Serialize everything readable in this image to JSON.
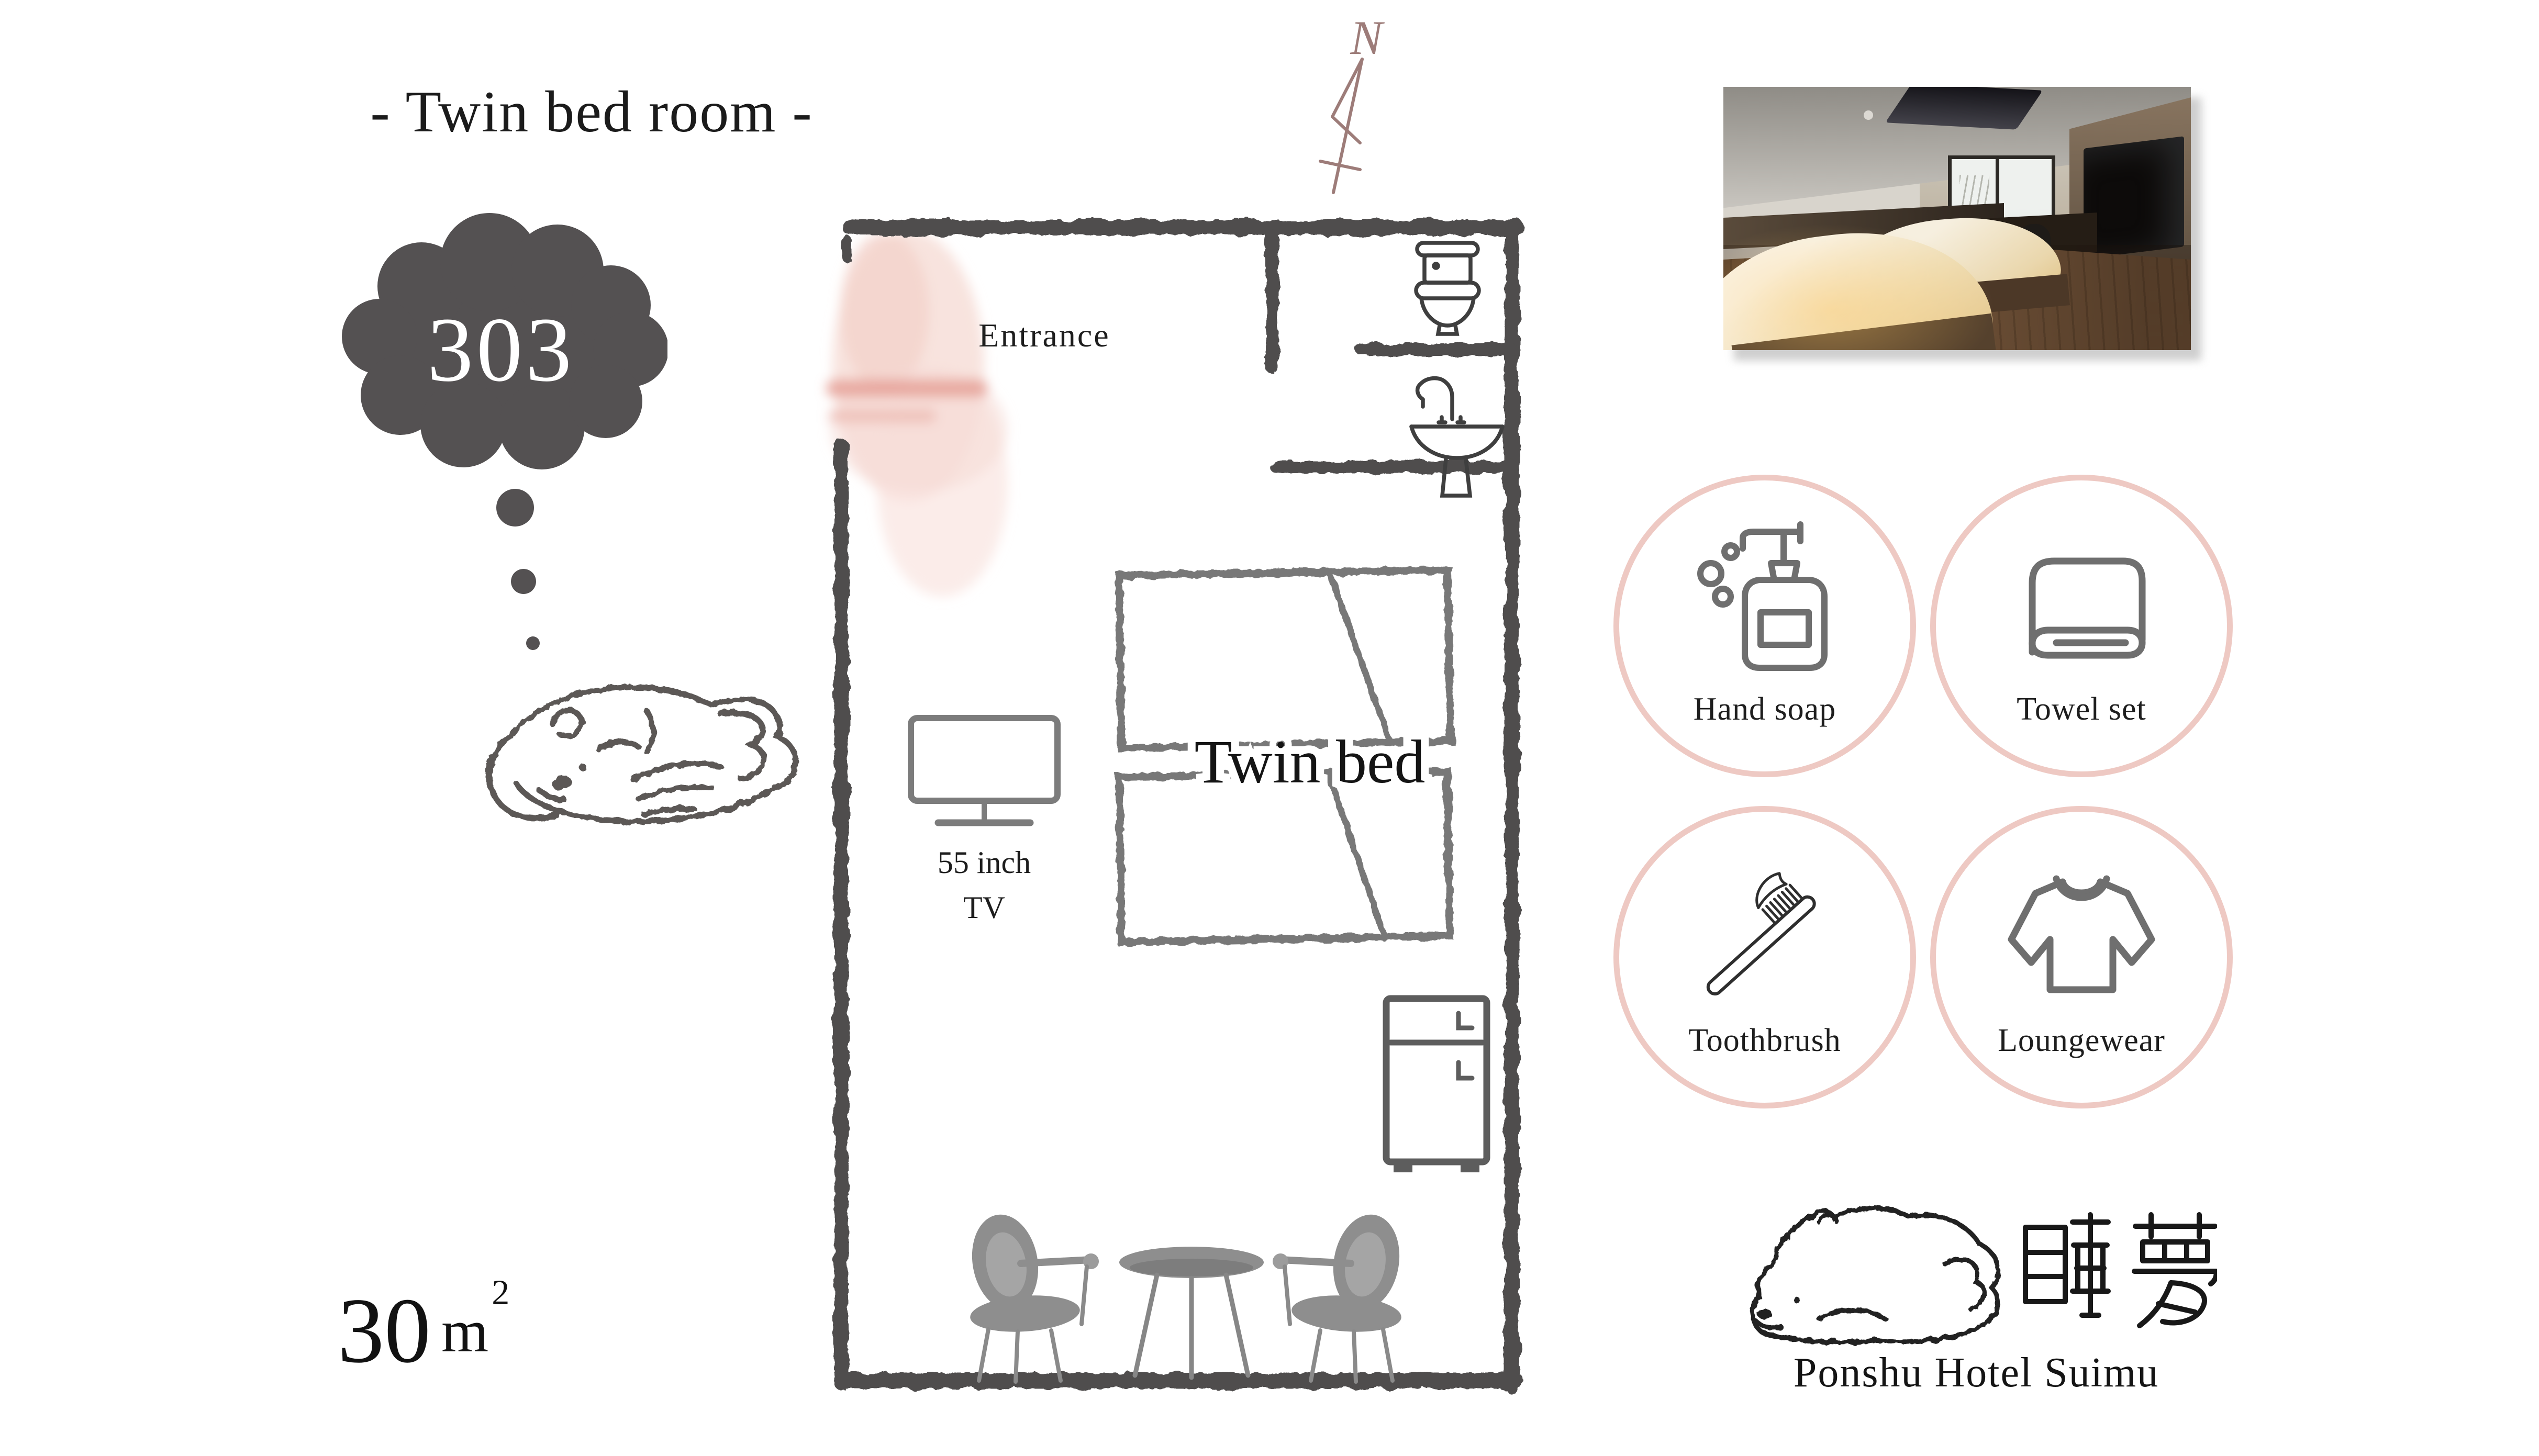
{
  "title": "- Twin bed room -",
  "room": {
    "number": "303",
    "area_value": "30",
    "area_unit": "m",
    "area_exponent": "2"
  },
  "compass": {
    "north_label": "N"
  },
  "floorplan": {
    "entrance_label": "Entrance",
    "bed_label": "Twin bed",
    "tv_label_line1": "55 inch",
    "tv_label_line2": "TV"
  },
  "amenities": [
    {
      "label": "Hand soap",
      "icon": "soap-dispenser-icon"
    },
    {
      "label": "Towel set",
      "icon": "towel-icon"
    },
    {
      "label": "Toothbrush",
      "icon": "toothbrush-icon"
    },
    {
      "label": "Loungewear",
      "icon": "loungewear-shirt-icon"
    }
  ],
  "logo": {
    "kanji": "睡夢",
    "hotel_name": "Ponshu Hotel Suimu"
  },
  "colors": {
    "accent_pink": "#eec9c3",
    "watercolor_pink": "#f3d2cb",
    "watercolor_pink_deep": "#e59d93",
    "crayon_wall_gray": "#4f4e4d",
    "fixture_gray": "#3f3f3f",
    "icon_gray": "#6f6f6f",
    "furniture_gray": "#8e8e8e",
    "cloud_gray": "#545152",
    "compass_mauve": "#9d7c79",
    "text_dark": "#1d1d1d"
  }
}
